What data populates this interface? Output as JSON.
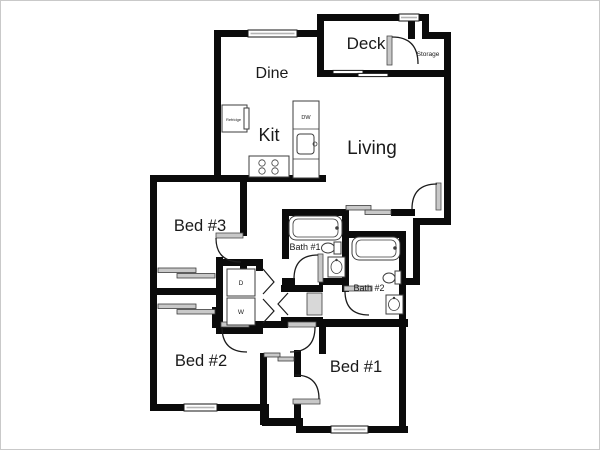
{
  "colors": {
    "wall": "#0b0b0b",
    "background": "#ffffff",
    "frame_border": "#c9c9c9",
    "fixture_gray": "#c8c8c8"
  },
  "rooms": {
    "deck": {
      "label": "Deck"
    },
    "storage": {
      "label": "Storage"
    },
    "dine": {
      "label": "Dine"
    },
    "kitchen": {
      "label": "Kit"
    },
    "living": {
      "label": "Living"
    },
    "bed3": {
      "label": "Bed #3"
    },
    "bed2": {
      "label": "Bed #2"
    },
    "bed1": {
      "label": "Bed #1"
    },
    "bath1": {
      "label": "Bath #1"
    },
    "bath2": {
      "label": "Bath #2"
    }
  },
  "appliances": {
    "refrigerator": {
      "label": "Refridge"
    },
    "dishwasher": {
      "label": "DW"
    },
    "dryer": {
      "label": "D"
    },
    "washer": {
      "label": "W"
    }
  }
}
